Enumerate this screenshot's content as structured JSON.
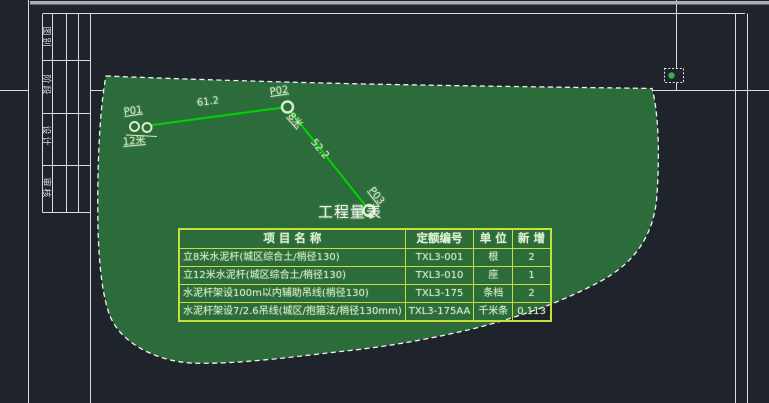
{
  "window": {
    "background": "#1e232c",
    "description": "CAD layout view with selected green wipeout region, pole route P01-P02-P03 and engineering quantity table"
  },
  "colors": {
    "frame_line": "#dcdcdc",
    "top_bar": "#a9aeb6",
    "region_fill": "#2c6b3a",
    "region_border": "#f2f2f2",
    "route_line": "#00d400",
    "cad_text": "#d2ecc2",
    "table_border": "#c6de3e",
    "selection_grip": "#2fb14f"
  },
  "title_block": {
    "labels": [
      "图别",
      "阶段",
      "设计",
      "审核"
    ]
  },
  "drawing": {
    "points": [
      {
        "id": "P01",
        "height": "12米"
      },
      {
        "id": "P02",
        "height": "8米"
      },
      {
        "id": "P03"
      }
    ],
    "spans": [
      {
        "length": "61.2"
      },
      {
        "length": "52.2"
      }
    ],
    "table_title": "工程量表"
  },
  "quantity_table": {
    "headers": [
      "项 目 名 称",
      "定额编号",
      "单 位",
      "新 增"
    ],
    "rows": [
      [
        "立8米水泥杆(城区综合土/梢径130)",
        "TXL3-001",
        "根",
        "2"
      ],
      [
        "立12米水泥杆(城区综合土/梢径130)",
        "TXL3-010",
        "座",
        "1"
      ],
      [
        "水泥杆架设100m以内辅助吊线(梢径130)",
        "TXL3-175",
        "条档",
        "2"
      ],
      [
        "水泥杆架设7/2.6吊线(城区/抱箍法/梢径130mm)",
        "TXL3-175AA",
        "千米条",
        "0.113"
      ]
    ]
  }
}
